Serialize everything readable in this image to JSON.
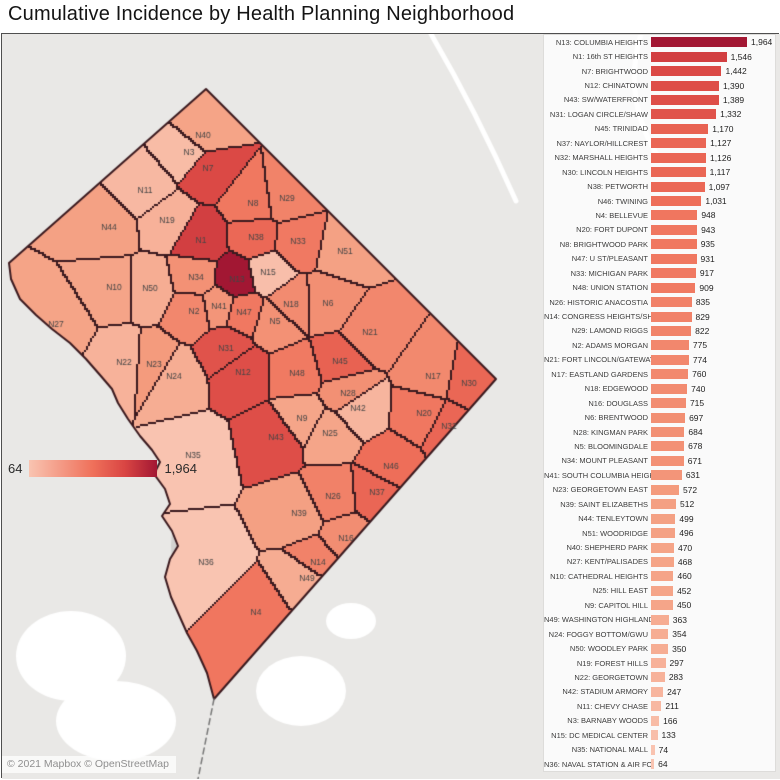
{
  "chart_data": {
    "type": "bar",
    "orientation": "horizontal",
    "title": "Cumulative Incidence by Health Planning Neighborhood",
    "xlim": [
      0,
      1964
    ],
    "legend_position": "map-overlay-left",
    "items": [
      {
        "id": "N13",
        "label": "N13: COLUMBIA HEIGHTS",
        "value": 1964,
        "value_text": "1,964"
      },
      {
        "id": "N1",
        "label": "N1: 16th ST HEIGHTS",
        "value": 1546,
        "value_text": "1,546"
      },
      {
        "id": "N7",
        "label": "N7: BRIGHTWOOD",
        "value": 1442,
        "value_text": "1,442"
      },
      {
        "id": "N12",
        "label": "N12: CHINATOWN",
        "value": 1390,
        "value_text": "1,390"
      },
      {
        "id": "N43",
        "label": "N43: SW/WATERFRONT",
        "value": 1389,
        "value_text": "1,389"
      },
      {
        "id": "N31",
        "label": "N31: LOGAN CIRCLE/SHAW",
        "value": 1332,
        "value_text": "1,332"
      },
      {
        "id": "N45",
        "label": "N45: TRINIDAD",
        "value": 1170,
        "value_text": "1,170"
      },
      {
        "id": "N37",
        "label": "N37: NAYLOR/HILLCREST",
        "value": 1127,
        "value_text": "1,127"
      },
      {
        "id": "N32",
        "label": "N32: MARSHALL HEIGHTS",
        "value": 1126,
        "value_text": "1,126"
      },
      {
        "id": "N30",
        "label": "N30: LINCOLN HEIGHTS",
        "value": 1117,
        "value_text": "1,117"
      },
      {
        "id": "N38",
        "label": "N38: PETWORTH",
        "value": 1097,
        "value_text": "1,097"
      },
      {
        "id": "N46",
        "label": "N46: TWINING",
        "value": 1031,
        "value_text": "1,031"
      },
      {
        "id": "N4",
        "label": "N4: BELLEVUE",
        "value": 948,
        "value_text": "948"
      },
      {
        "id": "N20",
        "label": "N20: FORT DUPONT",
        "value": 943,
        "value_text": "943"
      },
      {
        "id": "N8",
        "label": "N8: BRIGHTWOOD PARK",
        "value": 935,
        "value_text": "935"
      },
      {
        "id": "N47",
        "label": "N47: U ST/PLEASANT",
        "value": 931,
        "value_text": "931"
      },
      {
        "id": "N33",
        "label": "N33: MICHIGAN PARK",
        "value": 917,
        "value_text": "917"
      },
      {
        "id": "N48",
        "label": "N48: UNION STATION",
        "value": 909,
        "value_text": "909"
      },
      {
        "id": "N26",
        "label": "N26: HISTORIC ANACOSTIA",
        "value": 835,
        "value_text": "835"
      },
      {
        "id": "N14",
        "label": "N14: CONGRESS HEIGHTS/SHI..",
        "value": 829,
        "value_text": "829"
      },
      {
        "id": "N29",
        "label": "N29: LAMOND RIGGS",
        "value": 822,
        "value_text": "822"
      },
      {
        "id": "N2",
        "label": "N2: ADAMS MORGAN",
        "value": 775,
        "value_text": "775"
      },
      {
        "id": "N21",
        "label": "N21: FORT LINCOLN/GATEWAY",
        "value": 774,
        "value_text": "774"
      },
      {
        "id": "N17",
        "label": "N17: EASTLAND GARDENS",
        "value": 760,
        "value_text": "760"
      },
      {
        "id": "N18",
        "label": "N18: EDGEWOOD",
        "value": 740,
        "value_text": "740"
      },
      {
        "id": "N16",
        "label": "N16: DOUGLASS",
        "value": 715,
        "value_text": "715"
      },
      {
        "id": "N6",
        "label": "N6: BRENTWOOD",
        "value": 697,
        "value_text": "697"
      },
      {
        "id": "N28",
        "label": "N28: KINGMAN PARK",
        "value": 684,
        "value_text": "684"
      },
      {
        "id": "N5",
        "label": "N5: BLOOMINGDALE",
        "value": 678,
        "value_text": "678"
      },
      {
        "id": "N34",
        "label": "N34: MOUNT PLEASANT",
        "value": 671,
        "value_text": "671"
      },
      {
        "id": "N41",
        "label": "N41: SOUTH COLUMBIA HEIGHT..",
        "value": 631,
        "value_text": "631"
      },
      {
        "id": "N23",
        "label": "N23: GEORGETOWN EAST",
        "value": 572,
        "value_text": "572"
      },
      {
        "id": "N39",
        "label": "N39: SAINT ELIZABETHS",
        "value": 512,
        "value_text": "512"
      },
      {
        "id": "N44",
        "label": "N44: TENLEYTOWN",
        "value": 499,
        "value_text": "499"
      },
      {
        "id": "N51",
        "label": "N51: WOODRIDGE",
        "value": 496,
        "value_text": "496"
      },
      {
        "id": "N40",
        "label": "N40: SHEPHERD PARK",
        "value": 470,
        "value_text": "470"
      },
      {
        "id": "N27",
        "label": "N27: KENT/PALISADES",
        "value": 468,
        "value_text": "468"
      },
      {
        "id": "N10",
        "label": "N10: CATHEDRAL HEIGHTS",
        "value": 460,
        "value_text": "460"
      },
      {
        "id": "N25",
        "label": "N25: HILL EAST",
        "value": 452,
        "value_text": "452"
      },
      {
        "id": "N9",
        "label": "N9: CAPITOL HILL",
        "value": 450,
        "value_text": "450"
      },
      {
        "id": "N49",
        "label": "N49: WASHINGTON HIGHLANDS",
        "value": 363,
        "value_text": "363"
      },
      {
        "id": "N24",
        "label": "N24: FOGGY BOTTOM/GWU",
        "value": 354,
        "value_text": "354"
      },
      {
        "id": "N50",
        "label": "N50: WOODLEY PARK",
        "value": 350,
        "value_text": "350"
      },
      {
        "id": "N19",
        "label": "N19: FOREST HILLS",
        "value": 297,
        "value_text": "297"
      },
      {
        "id": "N22",
        "label": "N22: GEORGETOWN",
        "value": 283,
        "value_text": "283"
      },
      {
        "id": "N42",
        "label": "N42: STADIUM ARMORY",
        "value": 247,
        "value_text": "247"
      },
      {
        "id": "N11",
        "label": "N11: CHEVY CHASE",
        "value": 211,
        "value_text": "211"
      },
      {
        "id": "N3",
        "label": "N3: BARNABY WOODS",
        "value": 166,
        "value_text": "166"
      },
      {
        "id": "N15",
        "label": "N15: DC MEDICAL CENTER",
        "value": 133,
        "value_text": "133"
      },
      {
        "id": "N35",
        "label": "N35: NATIONAL MALL",
        "value": 74,
        "value_text": "74"
      },
      {
        "id": "N36",
        "label": "N36: NAVAL STATION & AIR FO..",
        "value": 64,
        "value_text": "64"
      }
    ]
  },
  "map": {
    "type": "choropleth",
    "attribution": "© 2021 Mapbox © OpenStreetMap",
    "legend": {
      "min_text": "64",
      "max_text": "1,964",
      "min_value": 64,
      "max_value": 1964
    },
    "color_stops": [
      {
        "t": 0.0,
        "color": "#f9c4b1"
      },
      {
        "t": 0.25,
        "color": "#f49e80"
      },
      {
        "t": 0.5,
        "color": "#ef705a"
      },
      {
        "t": 0.75,
        "color": "#d94543"
      },
      {
        "t": 1.0,
        "color": "#a21733"
      }
    ],
    "border_color": "#3b1a1f",
    "background_color": "#e9e8e6",
    "regions": [
      {
        "id": "N1",
        "x": 200,
        "y": 240
      },
      {
        "id": "N2",
        "x": 193,
        "y": 311
      },
      {
        "id": "N3",
        "x": 188,
        "y": 152
      },
      {
        "id": "N4",
        "x": 255,
        "y": 612
      },
      {
        "id": "N5",
        "x": 274,
        "y": 321
      },
      {
        "id": "N6",
        "x": 327,
        "y": 303
      },
      {
        "id": "N7",
        "x": 207,
        "y": 168
      },
      {
        "id": "N8",
        "x": 252,
        "y": 203
      },
      {
        "id": "N9",
        "x": 301,
        "y": 418
      },
      {
        "id": "N10",
        "x": 113,
        "y": 287
      },
      {
        "id": "N11",
        "x": 144,
        "y": 190
      },
      {
        "id": "N12",
        "x": 242,
        "y": 372
      },
      {
        "id": "N13",
        "x": 236,
        "y": 279
      },
      {
        "id": "N14",
        "x": 317,
        "y": 562
      },
      {
        "id": "N15",
        "x": 267,
        "y": 272
      },
      {
        "id": "N16",
        "x": 345,
        "y": 538
      },
      {
        "id": "N17",
        "x": 432,
        "y": 376
      },
      {
        "id": "N18",
        "x": 290,
        "y": 304
      },
      {
        "id": "N19",
        "x": 166,
        "y": 220
      },
      {
        "id": "N20",
        "x": 423,
        "y": 413
      },
      {
        "id": "N21",
        "x": 369,
        "y": 332
      },
      {
        "id": "N22",
        "x": 123,
        "y": 362
      },
      {
        "id": "N23",
        "x": 153,
        "y": 364
      },
      {
        "id": "N24",
        "x": 173,
        "y": 376
      },
      {
        "id": "N25",
        "x": 329,
        "y": 433
      },
      {
        "id": "N26",
        "x": 332,
        "y": 496
      },
      {
        "id": "N27",
        "x": 55,
        "y": 324
      },
      {
        "id": "N28",
        "x": 347,
        "y": 393
      },
      {
        "id": "N29",
        "x": 286,
        "y": 198
      },
      {
        "id": "N30",
        "x": 468,
        "y": 383
      },
      {
        "id": "N31",
        "x": 225,
        "y": 348
      },
      {
        "id": "N32",
        "x": 448,
        "y": 426
      },
      {
        "id": "N33",
        "x": 297,
        "y": 241
      },
      {
        "id": "N34",
        "x": 195,
        "y": 277
      },
      {
        "id": "N35",
        "x": 192,
        "y": 455
      },
      {
        "id": "N36",
        "x": 205,
        "y": 562
      },
      {
        "id": "N37",
        "x": 376,
        "y": 492
      },
      {
        "id": "N38",
        "x": 255,
        "y": 237
      },
      {
        "id": "N39",
        "x": 298,
        "y": 513
      },
      {
        "id": "N40",
        "x": 202,
        "y": 135
      },
      {
        "id": "N41",
        "x": 218,
        "y": 306
      },
      {
        "id": "N42",
        "x": 357,
        "y": 408
      },
      {
        "id": "N43",
        "x": 275,
        "y": 437
      },
      {
        "id": "N44",
        "x": 108,
        "y": 227
      },
      {
        "id": "N45",
        "x": 339,
        "y": 361
      },
      {
        "id": "N46",
        "x": 390,
        "y": 466
      },
      {
        "id": "N47",
        "x": 243,
        "y": 312
      },
      {
        "id": "N48",
        "x": 296,
        "y": 373
      },
      {
        "id": "N49",
        "x": 306,
        "y": 578
      },
      {
        "id": "N50",
        "x": 149,
        "y": 288
      },
      {
        "id": "N51",
        "x": 344,
        "y": 251
      }
    ]
  }
}
